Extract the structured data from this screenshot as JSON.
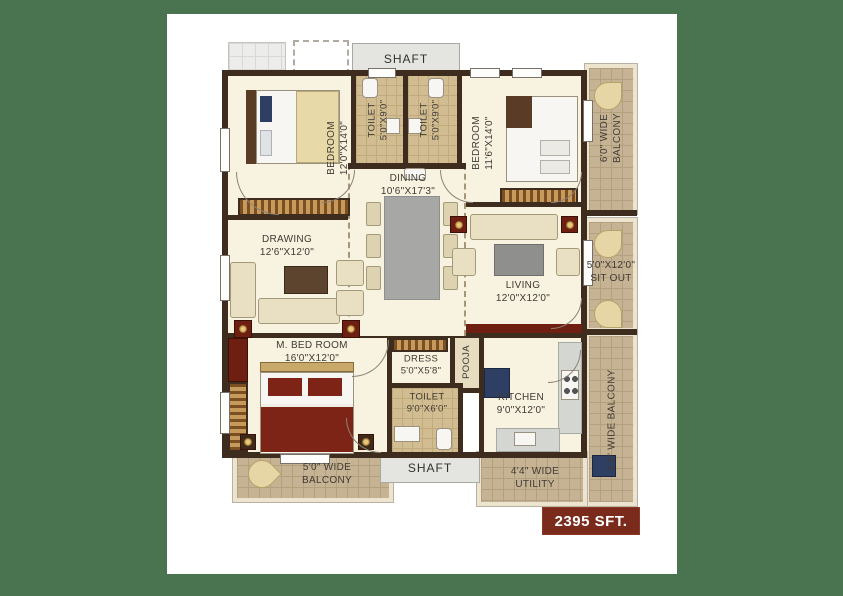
{
  "rooms": {
    "bedroom1": {
      "name": "BEDROOM",
      "dims": "12'0\"X14'0\""
    },
    "toilet1": {
      "name": "TOILET",
      "dims": "5'0\"X9'0\""
    },
    "toilet2": {
      "name": "TOILET",
      "dims": "5'0\"X9'0\""
    },
    "bedroom2": {
      "name": "BEDROOM",
      "dims": "11'6\"X14'0\""
    },
    "dining": {
      "name": "DINING",
      "dims": "10'6\"X17'3\""
    },
    "drawing": {
      "name": "DRAWING",
      "dims": "12'6\"X12'0\""
    },
    "living": {
      "name": "LIVING",
      "dims": "12'0\"X12'0\""
    },
    "master_bedroom": {
      "name": "M. BED ROOM",
      "dims": "16'0\"X12'0\""
    },
    "dress": {
      "name": "DRESS",
      "dims": "5'0\"X5'8\""
    },
    "pooja": {
      "name": "POOJA"
    },
    "toilet3": {
      "name": "TOILET",
      "dims": "9'0\"X6'0\""
    },
    "kitchen": {
      "name": "KITCHEN",
      "dims": "9'0\"X12'0\""
    }
  },
  "outdoor": {
    "shaft_top": "SHAFT",
    "shaft_bottom": "SHAFT",
    "balcony_right_l1": "6'0\" WIDE",
    "balcony_right_l2": "BALCONY",
    "sit_out_l1": "5'0\"X12'0\"",
    "sit_out_l2": "SIT OUT",
    "balcony_54": "5'4\" WIDE BALCONY",
    "balcony_bottom_l1": "5'0\" WIDE",
    "balcony_bottom_l2": "BALCONY",
    "utility_l1": "4'4\" WIDE",
    "utility_l2": "UTILITY"
  },
  "badge": {
    "area": "2395 SFT."
  },
  "colors": {
    "background_green": "#4a7350",
    "sheet_white": "#ffffff",
    "wall_brown": "#3e2d1e",
    "floor_cream": "#f8f2e0",
    "balcony_tan": "#c6b394",
    "badge_red": "#7b2b1b",
    "accent_maroon": "#6e1f12",
    "accent_navy": "#2e3f63"
  }
}
